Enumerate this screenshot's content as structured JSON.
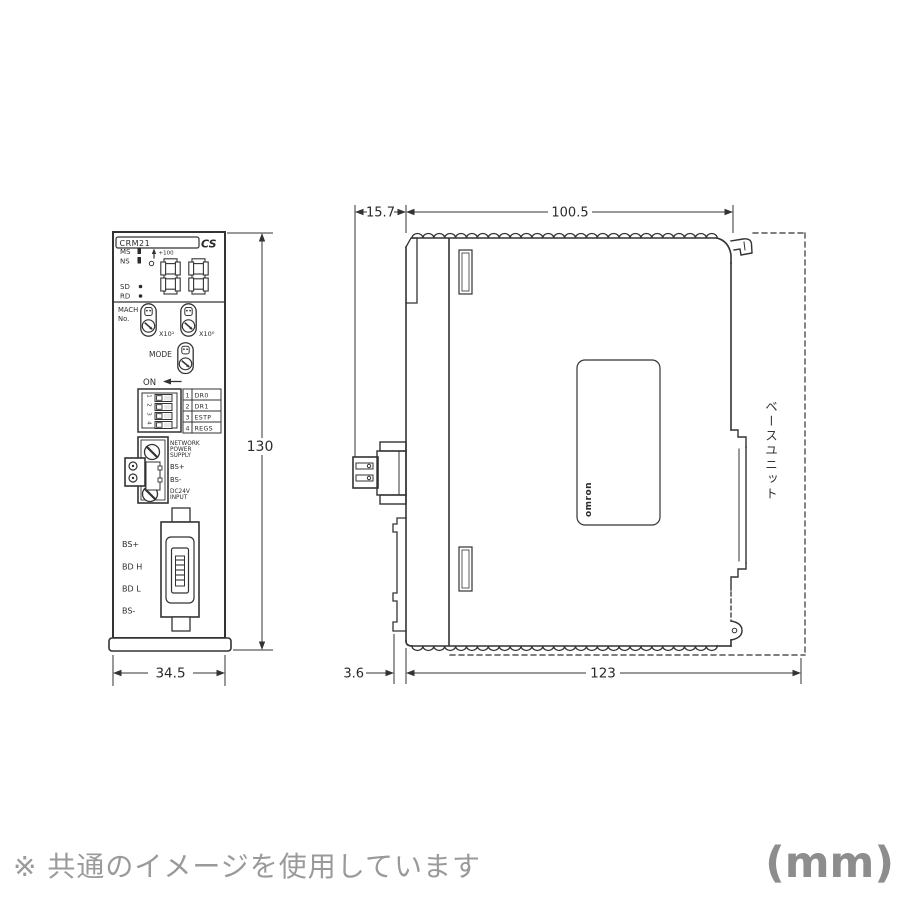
{
  "front": {
    "model": "CRM21",
    "series": "CS",
    "led_ms": "MS",
    "led_ns": "NS",
    "led_sd": "SD",
    "led_rd": "RD",
    "plus100": "+100",
    "mach_line1": "MACH",
    "mach_line2": "No.",
    "x10_1": "X10¹",
    "x10_0": "X10⁰",
    "mode": "MODE",
    "on": "ON",
    "dip_rows": [
      {
        "no": "1",
        "label": "DR0"
      },
      {
        "no": "2",
        "label": "DR1"
      },
      {
        "no": "3",
        "label": "ESTP"
      },
      {
        "no": "4",
        "label": "REGS"
      }
    ],
    "power_l1": "NETWORK",
    "power_l2": "POWER",
    "power_l3": "SUPPLY",
    "power_bs_plus": "BS+",
    "power_bs_minus": "BS-",
    "power_dc1": "DC24V",
    "power_dc2": "INPUT",
    "term_1": "BS+",
    "term_2": "BD H",
    "term_3": "BD L",
    "term_4": "BS-"
  },
  "side": {
    "brand": "omron",
    "base_unit": "ベースユニット"
  },
  "dims": {
    "height": "130",
    "width": "34.5",
    "front_offset": "15.7",
    "depth_body": "100.5",
    "rail_gap": "3.6",
    "depth_total": "123"
  },
  "footer": {
    "note": "※ 共通のイメージを使用しています",
    "unit": "(mm)"
  }
}
